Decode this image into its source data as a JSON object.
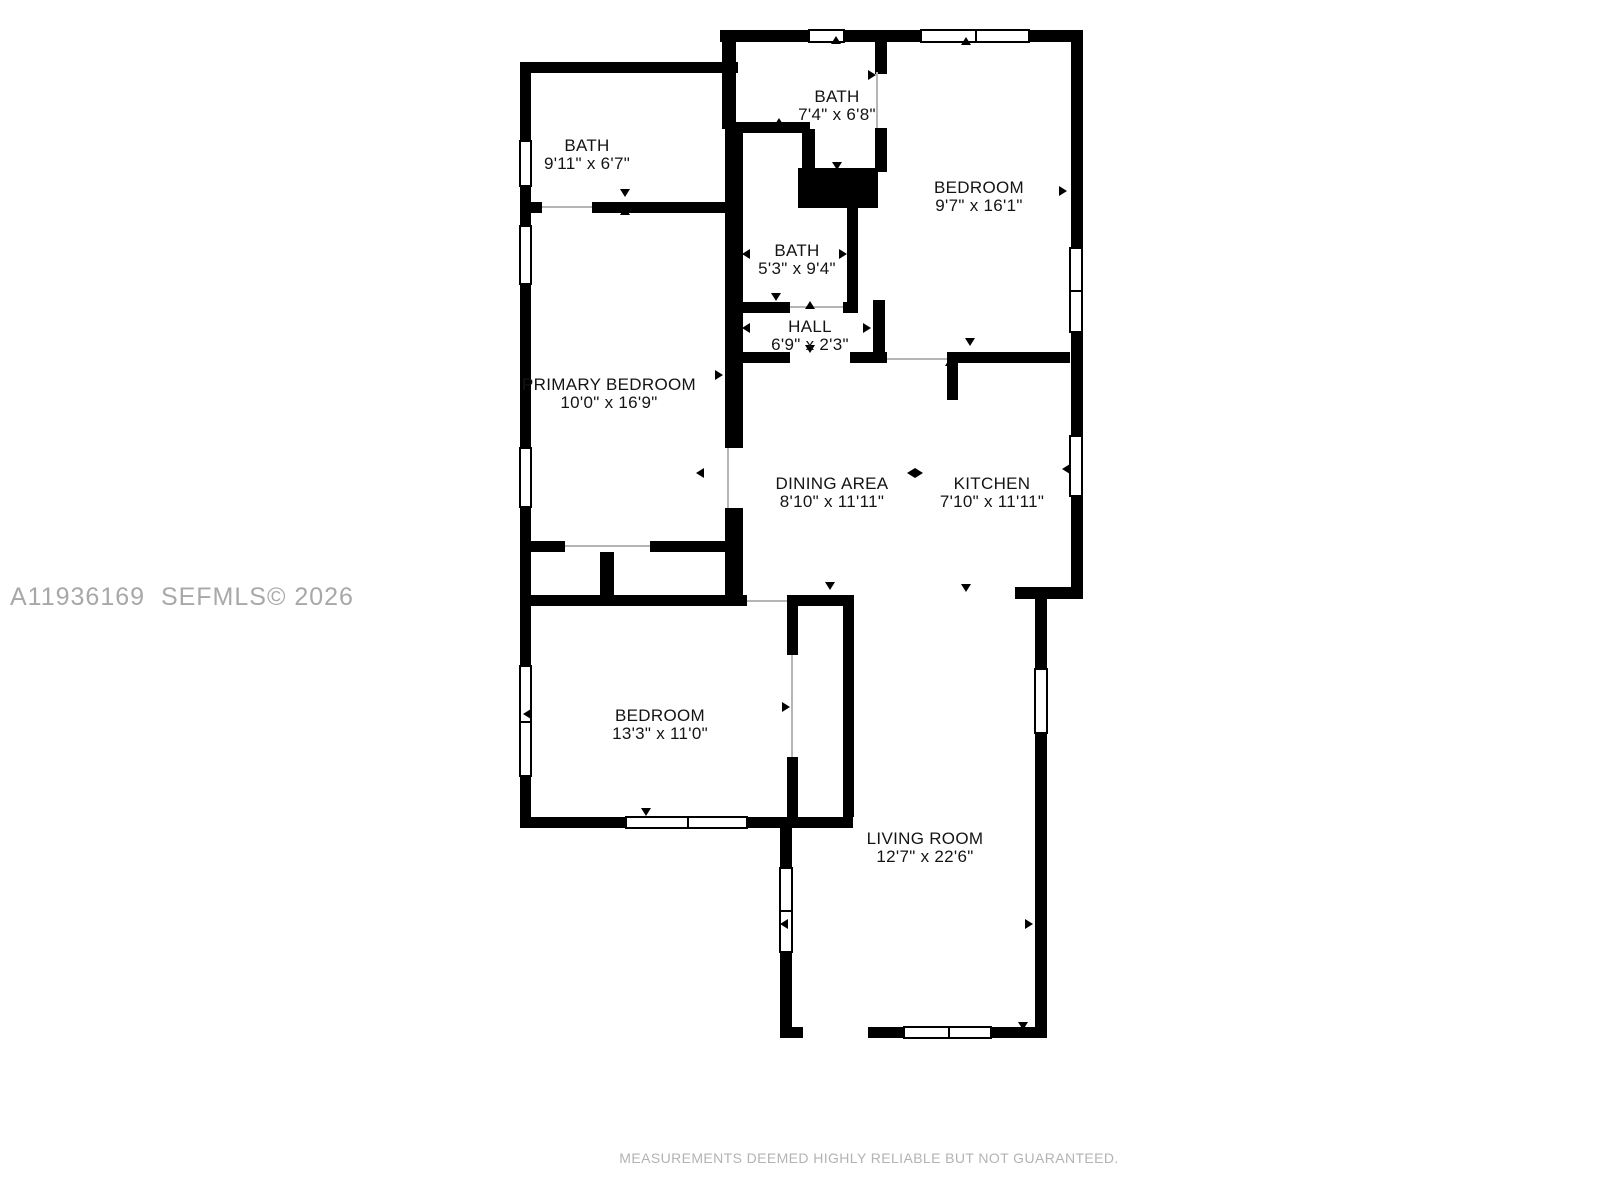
{
  "watermark": "A11936169  SEFMLS© 2026",
  "disclaimer": "MEASUREMENTS DEEMED HIGHLY RELIABLE BUT NOT GUARANTEED.",
  "colors": {
    "wall": "#000000",
    "label_text": "#141414",
    "watermark_text": "#a8a8a8",
    "disclaimer_text": "#b3b3b3",
    "background": "#ffffff"
  },
  "rooms": [
    {
      "name": "BATH",
      "dims": "9'11\" x 6'7\""
    },
    {
      "name": "BATH",
      "dims": "7'4\" x 6'8\""
    },
    {
      "name": "BEDROOM",
      "dims": "9'7\" x 16'1\""
    },
    {
      "name": "BATH",
      "dims": "5'3\" x 9'4\""
    },
    {
      "name": "HALL",
      "dims": "6'9\" x 2'3\""
    },
    {
      "name": "PRIMARY BEDROOM",
      "dims": "10'0\" x 16'9\""
    },
    {
      "name": "DINING AREA",
      "dims": "8'10\" x 11'11\""
    },
    {
      "name": "KITCHEN",
      "dims": "7'10\" x 11'11\""
    },
    {
      "name": "BEDROOM",
      "dims": "13'3\" x 11'0\""
    },
    {
      "name": "LIVING ROOM",
      "dims": "12'7\" x 22'6\""
    }
  ]
}
